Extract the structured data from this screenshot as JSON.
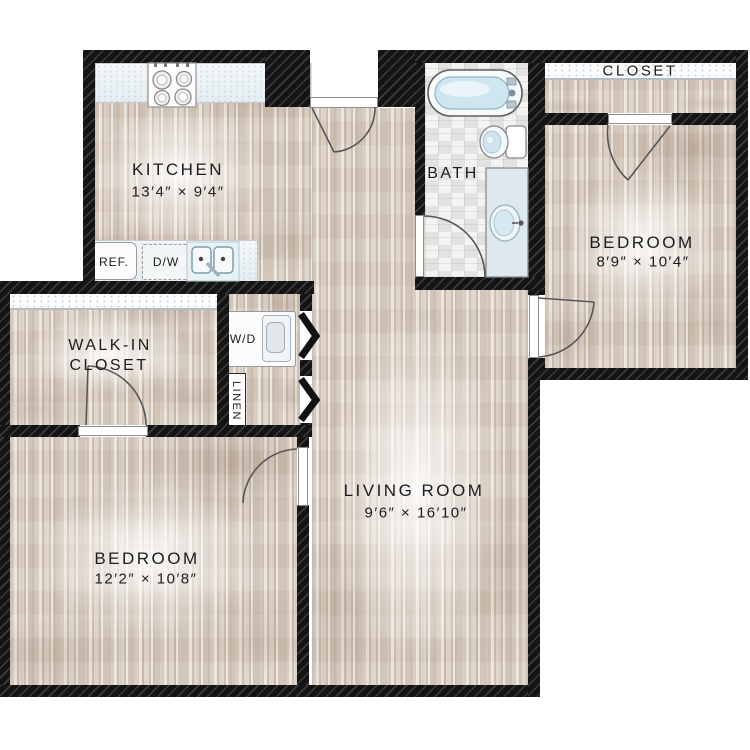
{
  "plan": {
    "type_label": "apartment floor plan",
    "colors": {
      "wall": "#141414",
      "wood_floor": "#d6cabd",
      "bath_tile": "#efeeec",
      "water_accent": "#cde6ef",
      "counter": "#ecf3f6",
      "background": "#ffffff",
      "text": "#1c1c1c"
    },
    "rooms": {
      "kitchen": {
        "name": "KITCHEN",
        "dims": "13′4″ × 9′4″"
      },
      "bath": {
        "name": "BATH"
      },
      "closet_top_right": {
        "name": "CLOSET"
      },
      "bedroom_top_right": {
        "name": "BEDROOM",
        "dims": "8′9″ × 10′4″"
      },
      "walk_in_closet": {
        "name_line1": "WALK-IN",
        "name_line2": "CLOSET"
      },
      "living_room": {
        "name": "LIVING ROOM",
        "dims": "9′6″ × 16′10″"
      },
      "bedroom_bottom_left": {
        "name": "BEDROOM",
        "dims": "12′2″ × 10′8″"
      }
    },
    "fixtures": {
      "refrigerator": "REF.",
      "dishwasher": "D/W",
      "washer_dryer": "W/D",
      "linen": "LINEN"
    }
  }
}
